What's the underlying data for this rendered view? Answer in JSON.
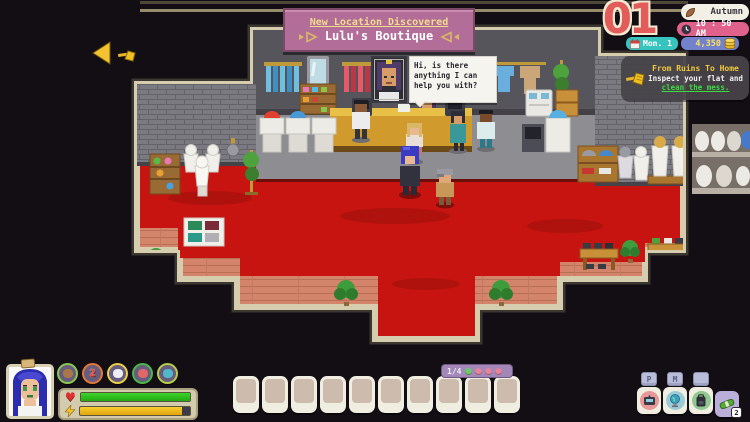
{
  "banner": {
    "title": "New Location Discovered",
    "subtitle": "Lulu's Boutique"
  },
  "dialogue": {
    "text": "Hi, is there anything I can help you with?"
  },
  "hud": {
    "day": "01",
    "season": "Autumn",
    "time": "10 : 50 AM",
    "date": "Mon. 1",
    "money": "4,350",
    "quest": {
      "title": "From Ruins To Home",
      "text": "Inspect your flat and ",
      "link": "clean the mess."
    }
  },
  "player": {
    "health_pct": 100,
    "energy_pct": 93,
    "buffs": [
      {
        "name": "mace-buff-icon",
        "ring": "#8ac850",
        "dot": "#a87848",
        "char": ""
      },
      {
        "name": "exp-buff-icon",
        "ring": "#e07838",
        "dot": "#e04838",
        "char": "2"
      },
      {
        "name": "paw-buff-icon",
        "ring": "#e8d048",
        "dot": "#eceef4",
        "char": ""
      },
      {
        "name": "fish-buff-icon",
        "ring": "#48b848",
        "dot": "#e06868",
        "char": ""
      },
      {
        "name": "bird-buff-icon",
        "ring": "#b8cc48",
        "dot": "#50b8c8",
        "char": ""
      }
    ]
  },
  "hotbar": {
    "slot_count": 10,
    "page": "1/4",
    "dots": [
      "#6fc76b",
      "#e2849b",
      "#e2849b",
      "#e2849b"
    ]
  },
  "menu": {
    "buttons": [
      {
        "name": "phone-button",
        "keycap": "P"
      },
      {
        "name": "map-button",
        "keycap": "M"
      },
      {
        "name": "inventory-button",
        "keycap": ""
      }
    ],
    "mail_badge": "2"
  },
  "colors": {
    "banner_pink": "#b26d98",
    "carpet_red": "#c81410",
    "hud_teal": "#38c4be",
    "hud_pink": "#e0618c",
    "hud_blue": "#7282cc",
    "border_cream": "#d6cdae"
  }
}
